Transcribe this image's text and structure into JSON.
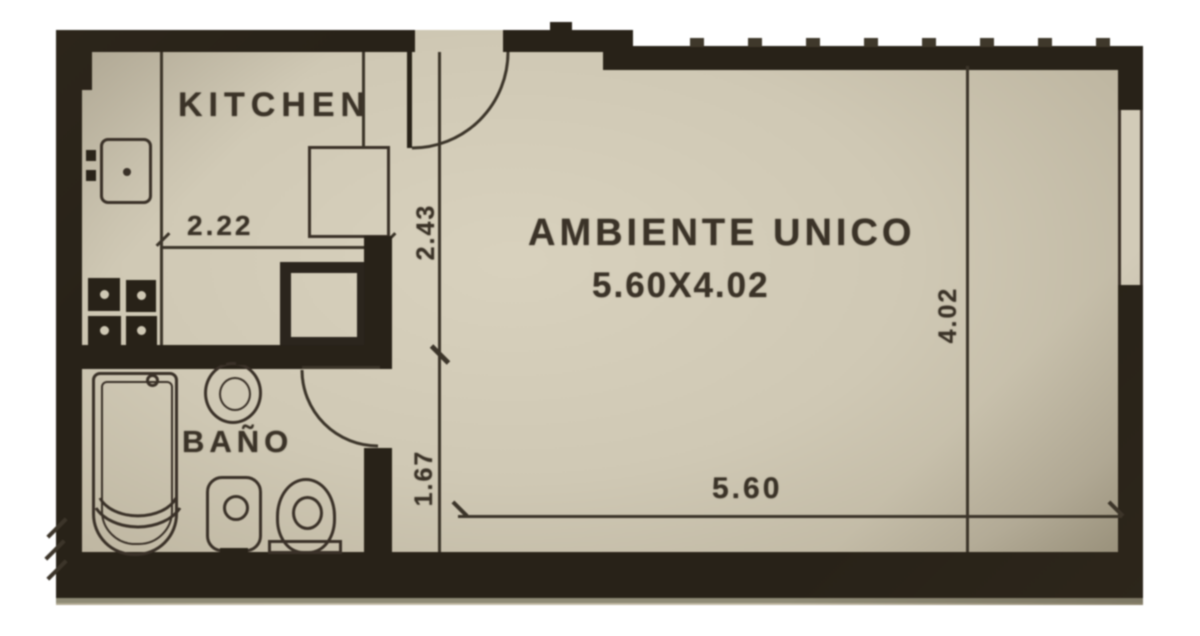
{
  "title": "Studio apartment floor plan",
  "plan": {
    "kitchen": {
      "label": "KITCHEN",
      "width": "2.22"
    },
    "bathroom": {
      "label": "BAÑO"
    },
    "main_room": {
      "name": "AMBIENTE UNICO",
      "size": "5.60X4.02",
      "width": "5.60",
      "height": "4.02"
    },
    "hall": {
      "upper": "2.43",
      "lower": "1.67"
    }
  },
  "colors": {
    "page": "#ffffff",
    "paper": "#cfc8b4",
    "wall": "#282218",
    "ink": "#3b3328"
  }
}
